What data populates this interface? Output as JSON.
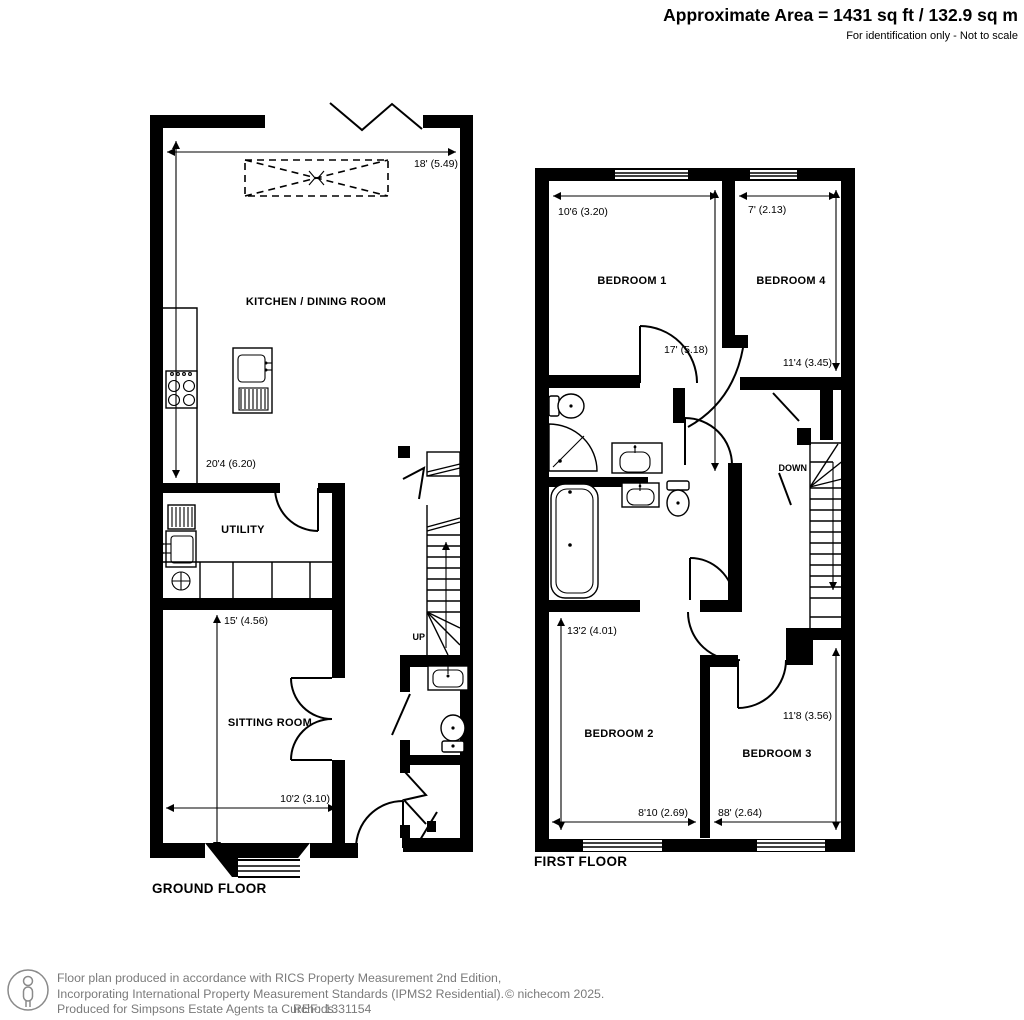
{
  "header": {
    "area": "Approximate Area = 1431 sq ft / 132.9 sq m",
    "note": "For identification only - Not to scale"
  },
  "ground_floor": {
    "title": "GROUND FLOOR",
    "rooms": {
      "kitchen_dining": "KITCHEN / DINING ROOM",
      "utility": "UTILITY",
      "sitting": "SITTING ROOM"
    },
    "dims": {
      "kitchen_width": "18' (5.49)",
      "kitchen_length": "20'4 (6.20)",
      "sitting_length": "15' (4.56)",
      "sitting_width": "10'2 (3.10)"
    },
    "stair_direction": "UP"
  },
  "first_floor": {
    "title": "FIRST FLOOR",
    "rooms": {
      "bedroom1": "BEDROOM 1",
      "bedroom2": "BEDROOM 2",
      "bedroom3": "BEDROOM 3",
      "bedroom4": "BEDROOM 4"
    },
    "dims": {
      "bedroom1_width": "10'6 (3.20)",
      "bedroom4_width": "7' (2.13)",
      "bedroom1_length": "17' (5.18)",
      "bedroom4_length": "11'4 (3.45)",
      "bedroom2_length": "13'2 (4.01)",
      "bedroom3_length": "11'8 (3.56)",
      "bedroom2_width": "8'10 (2.69)",
      "bedroom3_width": "88' (2.64)"
    },
    "stair_direction": "DOWN"
  },
  "footer": {
    "line1": "Floor plan produced in accordance with RICS Property Measurement 2nd Edition,",
    "line2": "Incorporating International Property Measurement Standards (IPMS2 Residential).",
    "copyright": "© nichecom 2025.",
    "line3": "Produced for Simpsons Estate Agents ta Curchods.",
    "ref": "REF: 1331154"
  },
  "colors": {
    "wall": "#000000",
    "footer_text": "#7a7a7a",
    "background": "#ffffff"
  }
}
